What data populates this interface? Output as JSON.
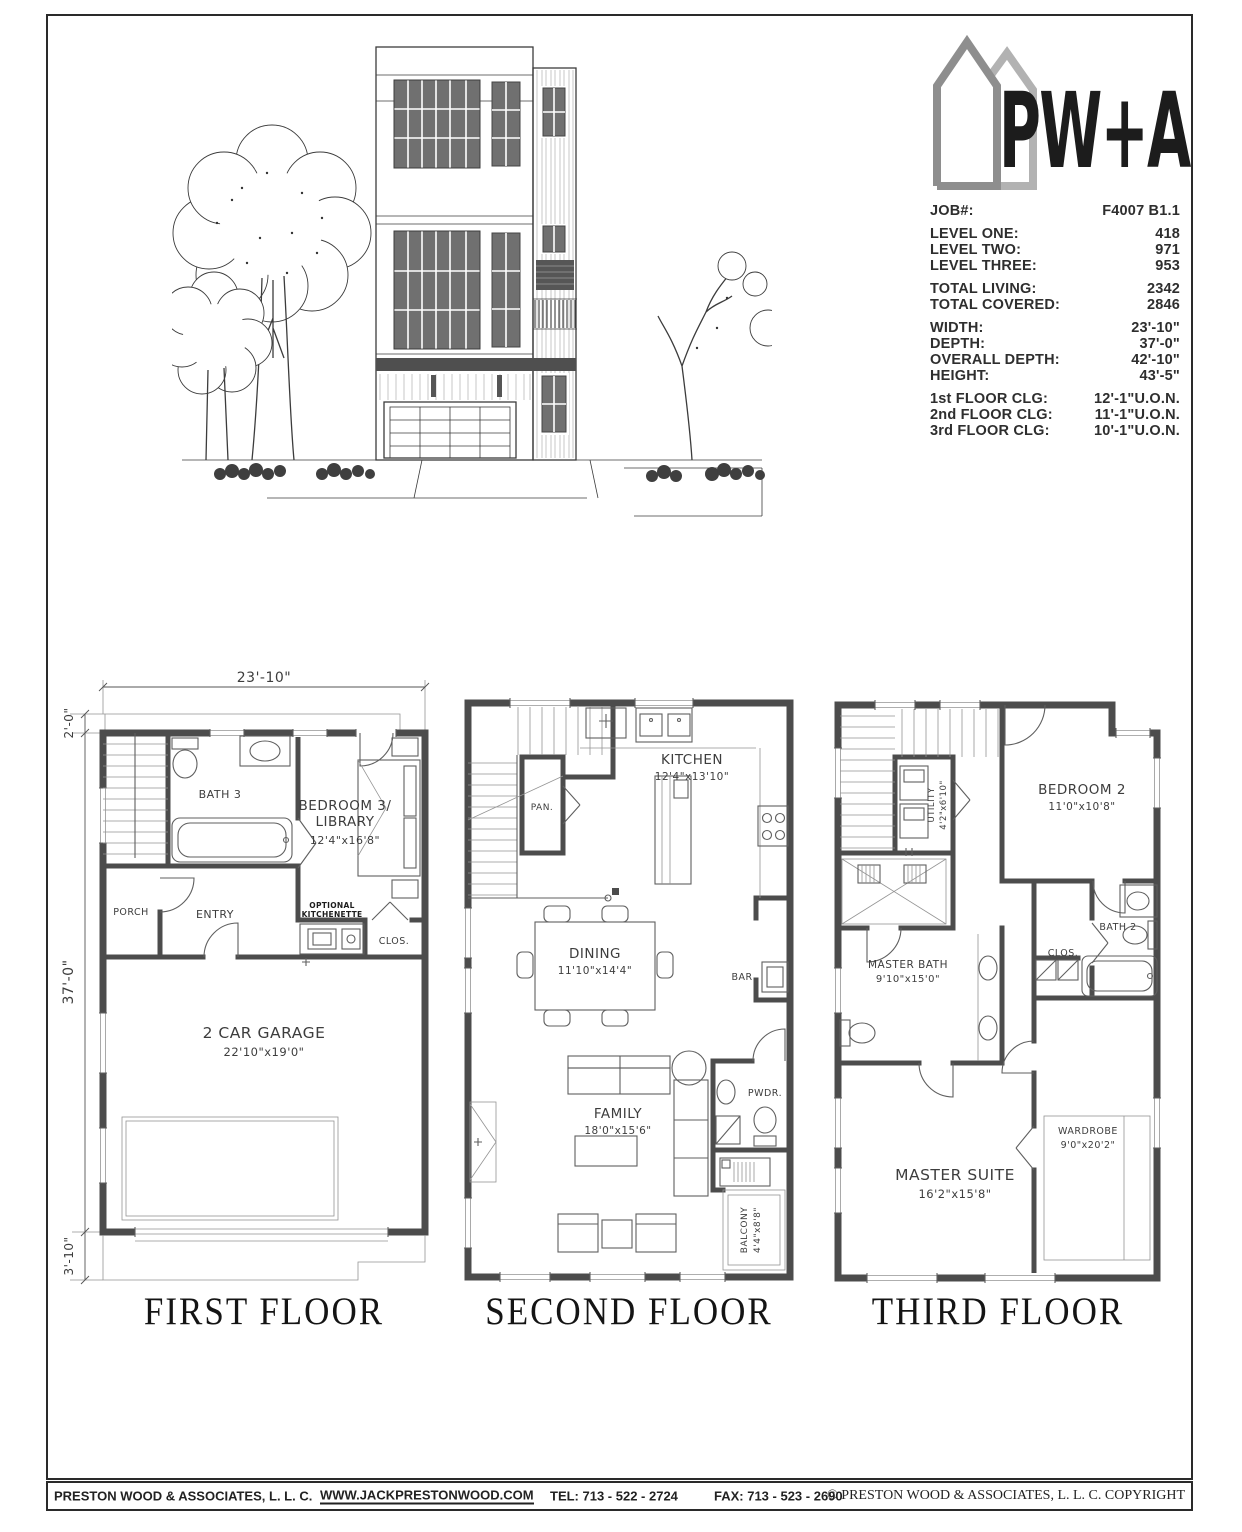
{
  "logo": {
    "brand": "PW+A",
    "icon": "twin-houses-icon"
  },
  "job": {
    "rows": [
      {
        "label": "JOB#:",
        "value": "F4007 B1.1"
      },
      {
        "label": "LEVEL ONE:",
        "value": "418"
      },
      {
        "label": "LEVEL TWO:",
        "value": "971"
      },
      {
        "label": "LEVEL THREE:",
        "value": "953"
      },
      {
        "label": "TOTAL LIVING:",
        "value": "2342"
      },
      {
        "label": "TOTAL COVERED:",
        "value": "2846"
      },
      {
        "label": "WIDTH:",
        "value": "23'-10\""
      },
      {
        "label": "DEPTH:",
        "value": "37'-0\""
      },
      {
        "label": "OVERALL DEPTH:",
        "value": "42'-10\""
      },
      {
        "label": "HEIGHT:",
        "value": "43'-5\""
      },
      {
        "label": "1st FLOOR CLG:",
        "value": "12'-1\"U.O.N."
      },
      {
        "label": "2nd FLOOR CLG:",
        "value": "11'-1\"U.O.N."
      },
      {
        "label": "3rd FLOOR CLG:",
        "value": "10'-1\"U.O.N."
      }
    ]
  },
  "floor1": {
    "title": "FIRST FLOOR",
    "dim_width": "23'-10\"",
    "dim_stair": "2'-0\"",
    "dim_depth": "37'-0\"",
    "dim_porch": "3'-10\"",
    "bath": "BATH 3",
    "bedroom_line1": "BEDROOM 3/",
    "bedroom_line2": "LIBRARY",
    "bedroom_dim": "12'4\"x16'8\"",
    "porch": "PORCH",
    "entry": "ENTRY",
    "kitchenette_line1": "OPTIONAL",
    "kitchenette_line2": "KITCHENETTE",
    "closet": "CLOS.",
    "garage": "2 CAR GARAGE",
    "garage_dim": "22'10\"x19'0\""
  },
  "floor2": {
    "title": "SECOND FLOOR",
    "kitchen": "KITCHEN",
    "kitchen_dim": "12'4\"x13'10\"",
    "pantry": "PAN.",
    "dining": "DINING",
    "dining_dim": "11'10\"x14'4\"",
    "bar": "BAR",
    "family": "FAMILY",
    "family_dim": "18'0\"x15'6\"",
    "powder": "PWDR.",
    "balcony": "BALCONY",
    "balcony_dim": "4'4\"x8'8\""
  },
  "floor3": {
    "title": "THIRD FLOOR",
    "utility": "UTILITY",
    "utility_dim": "4'2\"x6'10\"",
    "bedroom2": "BEDROOM 2",
    "bedroom2_dim": "11'0\"x10'8\"",
    "closet": "CLOS.",
    "bath2": "BATH 2",
    "master_bath": "MASTER BATH",
    "master_bath_dim": "9'10\"x15'0\"",
    "master_suite": "MASTER SUITE",
    "master_suite_dim": "16'2\"x15'8\"",
    "wardrobe": "WARDROBE",
    "wardrobe_dim": "9'0\"x20'2\""
  },
  "footer": {
    "company": "PRESTON WOOD & ASSOCIATES, L. L. C.",
    "website": "WWW.JACKPRESTONWOOD.COM",
    "tel": "TEL:  713 - 522 - 2724",
    "fax": "FAX:  713 - 523 - 2690",
    "copyright": "© PRESTON WOOD & ASSOCIATES, L. L. C.  COPYRIGHT"
  }
}
